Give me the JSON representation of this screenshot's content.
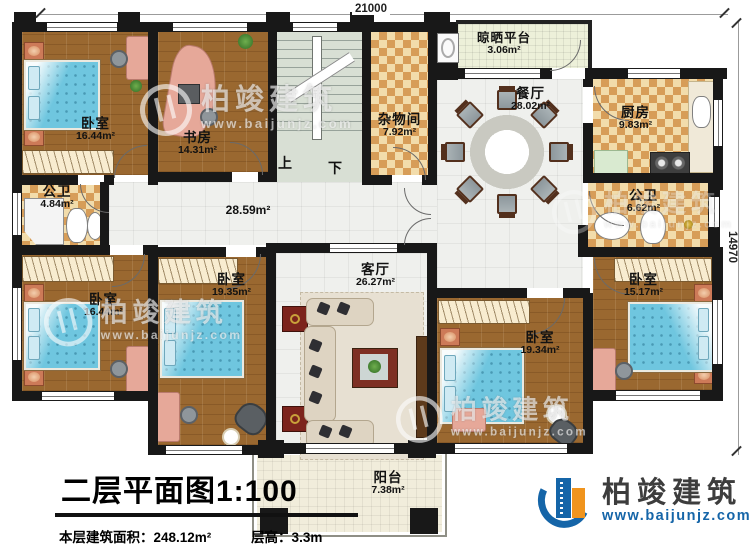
{
  "plan": {
    "dim_top": "21000",
    "dim_right": "14970",
    "stairs_up": "上",
    "stairs_down": "下",
    "hall_area": "28.59m²"
  },
  "rooms": {
    "bedroom_tl": {
      "name": "卧室",
      "area": "16.44m²"
    },
    "study": {
      "name": "书房",
      "area": "14.31m²"
    },
    "bath_left": {
      "name": "公卫",
      "area": "4.84m²"
    },
    "storage": {
      "name": "杂物间",
      "area": "7.92m²"
    },
    "drying": {
      "name": "晾晒平台",
      "area": "3.06m²"
    },
    "dining": {
      "name": "餐厅",
      "area": "28.02m²"
    },
    "kitchen": {
      "name": "厨房",
      "area": "9.83m²"
    },
    "bath_right": {
      "name": "公卫",
      "area": "6.62m²"
    },
    "bedroom_bl": {
      "name": "卧室",
      "area": "16.44m²"
    },
    "bedroom_b2": {
      "name": "卧室",
      "area": "19.35m²"
    },
    "living": {
      "name": "客厅",
      "area": "26.27m²"
    },
    "bedroom_br1": {
      "name": "卧室",
      "area": "19.34m²"
    },
    "bedroom_br2": {
      "name": "卧室",
      "area": "15.17m²"
    },
    "balcony": {
      "name": "阳台",
      "area": "7.38m²"
    }
  },
  "title_block": {
    "title": "二层平面图1:100",
    "floor_area": "本层建筑面积：248.12m²",
    "floor_height": "层高：3.3m"
  },
  "brand": {
    "name": "柏竣建筑",
    "url": "www.baijunjz.com"
  },
  "watermark": {
    "name": "柏竣建筑",
    "url": "www.baijunjz.com"
  }
}
